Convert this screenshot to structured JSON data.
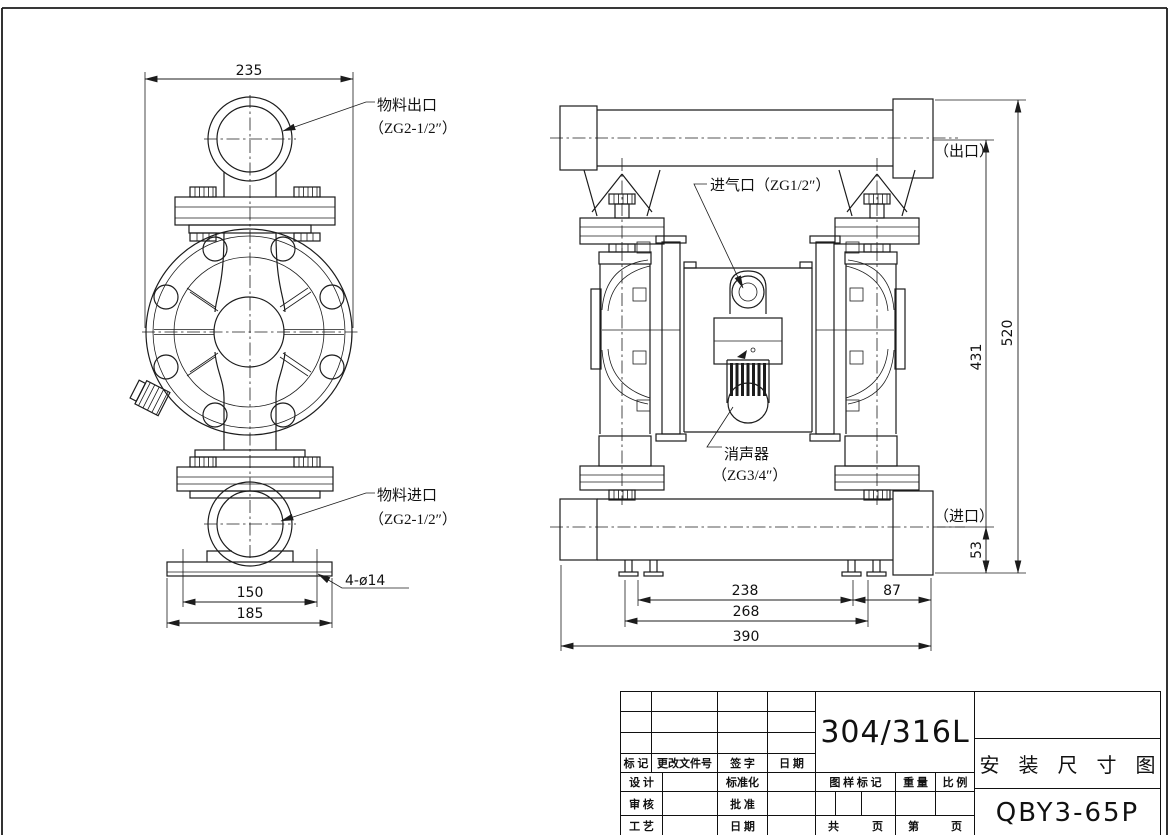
{
  "front_view": {
    "dim_diameter": "235",
    "dim_hole_span": "150",
    "dim_base_width": "185",
    "holes_label": "4-ø14",
    "outlet_label_1": "物料出口",
    "outlet_label_2": "（ZG2-1/2″）",
    "inlet_label_1": "物料进口",
    "inlet_label_2": "（ZG2-1/2″）"
  },
  "side_view": {
    "air_inlet_label": "进气口（ZG1/2″）",
    "muffler_label_1": "消声器",
    "muffler_label_2": "（ZG3/4″）",
    "outlet_note": "（出口）",
    "inlet_note": "（进口）",
    "dim_outlet_height": "431",
    "dim_total_height": "520",
    "dim_inlet_height": "53",
    "dim_feet_inner": "238",
    "dim_feet_outer": "268",
    "dim_total_width": "390",
    "dim_right_offset": "87"
  },
  "title_block": {
    "material": "304/316L",
    "drawing_title": "安 装 尺 寸 图",
    "model": "QBY3-65P",
    "mark": "标 记",
    "change_doc": "更改文件号",
    "signature": "签 字",
    "date": "日 期",
    "design": "设 计",
    "standardize": "标准化",
    "check": "审 核",
    "approve": "批 准",
    "craft": "工 艺",
    "date2": "日 期",
    "stamp": "图 样 标 记",
    "weight": "重 量",
    "scale": "比 例",
    "sheets_a": "共",
    "sheets_b": "页",
    "sheet_a": "第",
    "sheet_b": "页"
  }
}
